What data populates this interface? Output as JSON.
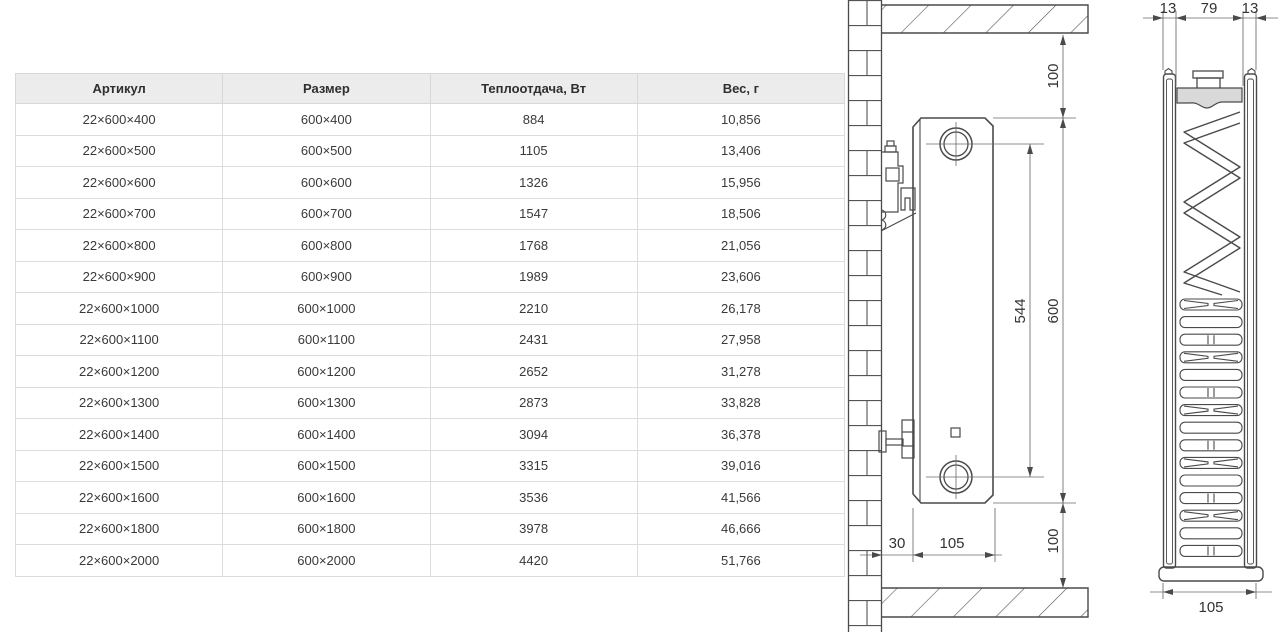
{
  "table": {
    "columns": [
      "Артикул",
      "Размер",
      "Теплоотдача, Вт",
      "Вес, г"
    ],
    "rows": [
      [
        "22×600×400",
        "600×400",
        "884",
        "10,856"
      ],
      [
        "22×600×500",
        "600×500",
        "1105",
        "13,406"
      ],
      [
        "22×600×600",
        "600×600",
        "1326",
        "15,956"
      ],
      [
        "22×600×700",
        "600×700",
        "1547",
        "18,506"
      ],
      [
        "22×600×800",
        "600×800",
        "1768",
        "21,056"
      ],
      [
        "22×600×900",
        "600×900",
        "1989",
        "23,606"
      ],
      [
        "22×600×1000",
        "600×1000",
        "2210",
        "26,178"
      ],
      [
        "22×600×1100",
        "600×1100",
        "2431",
        "27,958"
      ],
      [
        "22×600×1200",
        "600×1200",
        "2652",
        "31,278"
      ],
      [
        "22×600×1300",
        "600×1300",
        "2873",
        "33,828"
      ],
      [
        "22×600×1400",
        "600×1400",
        "3094",
        "36,378"
      ],
      [
        "22×600×1500",
        "600×1500",
        "3315",
        "39,016"
      ],
      [
        "22×600×1600",
        "600×1600",
        "3536",
        "41,566"
      ],
      [
        "22×600×1800",
        "600×1800",
        "3978",
        "46,666"
      ],
      [
        "22×600×2000",
        "600×2000",
        "4420",
        "51,766"
      ]
    ],
    "header_bg": "#ececec",
    "border_color": "#d8d8d8",
    "text_color": "#3a3a3a"
  },
  "drawing": {
    "line_color": "#4a4a4a",
    "fill_gray": "#d9d9d9",
    "side_view": {
      "top_clearance": "100",
      "connection_spacing": "544",
      "height": "600",
      "bottom_clearance": "100",
      "wall_gap": "30",
      "depth": "105"
    },
    "section_view": {
      "front_panel": "13",
      "core_width": "79",
      "back_panel": "13",
      "total_depth": "105"
    }
  }
}
